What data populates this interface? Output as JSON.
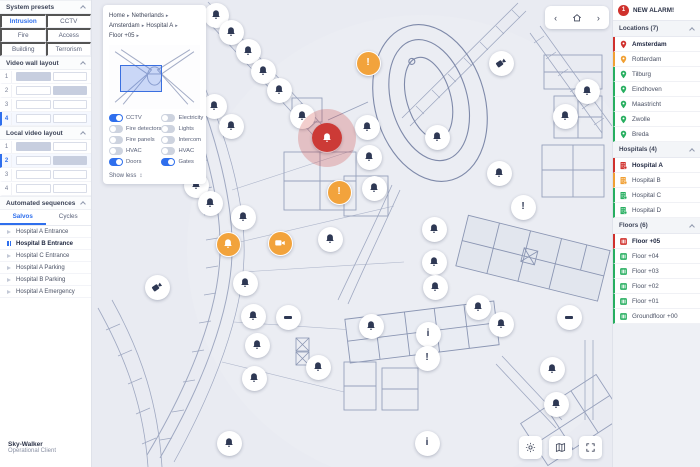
{
  "app": {
    "name": "Sky-Walker",
    "subtitle": "Operational Client"
  },
  "left_sidebar": {
    "system_presets": {
      "title": "System presets",
      "items": [
        {
          "label": "Intrusion",
          "active": true
        },
        {
          "label": "CCTV"
        },
        {
          "label": "Fire"
        },
        {
          "label": "Access"
        },
        {
          "label": "Building"
        },
        {
          "label": "Terrorism"
        }
      ]
    },
    "video_wall": {
      "title": "Video wall layout",
      "rows": [
        {
          "n": "1",
          "t1": "f",
          "t2": "e"
        },
        {
          "n": "2",
          "t1": "e",
          "t2": "f"
        },
        {
          "n": "3",
          "t1": "e",
          "t2": "e"
        },
        {
          "n": "4",
          "t1": "e",
          "t2": "e",
          "selected": true
        }
      ]
    },
    "local_video": {
      "title": "Local video layout",
      "rows": [
        {
          "n": "1",
          "t1": "f",
          "t2": "e"
        },
        {
          "n": "2",
          "t1": "e",
          "t2": "f",
          "selected": true
        },
        {
          "n": "3",
          "t1": "e",
          "t2": "e"
        },
        {
          "n": "4",
          "t1": "e",
          "t2": "e"
        }
      ]
    },
    "sequences": {
      "title": "Automated sequences",
      "tabs": [
        {
          "label": "Salvos",
          "active": true
        },
        {
          "label": "Cycles"
        }
      ],
      "items": [
        {
          "label": "Hospital A Entrance",
          "state": "play"
        },
        {
          "label": "Hospital B Entrance",
          "state": "pause",
          "active": true
        },
        {
          "label": "Hospital C Entrance",
          "state": "play"
        },
        {
          "label": "Hospital A Parking",
          "state": "play"
        },
        {
          "label": "Hospital B Parking",
          "state": "play"
        },
        {
          "label": "Hospital A Emergency",
          "state": "play"
        }
      ]
    }
  },
  "map": {
    "breadcrumb": [
      "Home",
      "Netherlands",
      "Amsterdam",
      "Hospital A",
      "Floor +05"
    ],
    "layers_panel": {
      "toggles": [
        {
          "label": "CCTV",
          "state": "on"
        },
        {
          "label": "Electricity",
          "state": "off"
        },
        {
          "label": "Fire detectors",
          "state": "off"
        },
        {
          "label": "Lights",
          "state": "off"
        },
        {
          "label": "Fire panels",
          "state": "off"
        },
        {
          "label": "Intercom",
          "state": "off"
        },
        {
          "label": "HVAC",
          "state": "off"
        },
        {
          "label": "HVAC",
          "state": "off"
        },
        {
          "label": "Doors",
          "state": "on"
        },
        {
          "label": "Gates",
          "state": "on"
        }
      ],
      "show_less": "Show less"
    },
    "nav": {
      "back": "‹",
      "forward": "›",
      "home_icon": "home-icon"
    },
    "controls": [
      "brightness-icon",
      "map-icon",
      "fullscreen-icon"
    ],
    "markers": [
      {
        "x": 124,
        "y": 15,
        "type": "bell"
      },
      {
        "x": 139,
        "y": 32,
        "type": "bell"
      },
      {
        "x": 156,
        "y": 51,
        "type": "bell"
      },
      {
        "x": 171,
        "y": 71,
        "type": "bell"
      },
      {
        "x": 187,
        "y": 90,
        "type": "bell"
      },
      {
        "x": 210,
        "y": 116,
        "type": "bell"
      },
      {
        "x": 235,
        "y": 138,
        "type": "alarm"
      },
      {
        "x": 276,
        "y": 63,
        "type": "alert-orange"
      },
      {
        "x": 275,
        "y": 127,
        "type": "bell"
      },
      {
        "x": 277,
        "y": 157,
        "type": "bell"
      },
      {
        "x": 282,
        "y": 188,
        "type": "bell"
      },
      {
        "x": 247,
        "y": 192,
        "type": "alert-orange"
      },
      {
        "x": 122,
        "y": 106,
        "type": "bell"
      },
      {
        "x": 139,
        "y": 126,
        "type": "bell"
      },
      {
        "x": 104,
        "y": 185,
        "type": "bell"
      },
      {
        "x": 118,
        "y": 203,
        "type": "bell"
      },
      {
        "x": 151,
        "y": 217,
        "type": "bell"
      },
      {
        "x": 136,
        "y": 244,
        "type": "bell-orange"
      },
      {
        "x": 188,
        "y": 243,
        "type": "camera-orange"
      },
      {
        "x": 238,
        "y": 239,
        "type": "bell"
      },
      {
        "x": 409,
        "y": 63,
        "type": "camera"
      },
      {
        "x": 495,
        "y": 91,
        "type": "bell"
      },
      {
        "x": 473,
        "y": 116,
        "type": "bell"
      },
      {
        "x": 407,
        "y": 173,
        "type": "bell"
      },
      {
        "x": 431,
        "y": 207,
        "type": "alert"
      },
      {
        "x": 345,
        "y": 137,
        "type": "bell"
      },
      {
        "x": 342,
        "y": 229,
        "type": "bell"
      },
      {
        "x": 342,
        "y": 262,
        "type": "bell"
      },
      {
        "x": 343,
        "y": 287,
        "type": "bell"
      },
      {
        "x": 386,
        "y": 307,
        "type": "bell"
      },
      {
        "x": 409,
        "y": 324,
        "type": "bell"
      },
      {
        "x": 477,
        "y": 317,
        "type": "door"
      },
      {
        "x": 336,
        "y": 334,
        "type": "info"
      },
      {
        "x": 335,
        "y": 358,
        "type": "alert"
      },
      {
        "x": 460,
        "y": 369,
        "type": "bell"
      },
      {
        "x": 464,
        "y": 404,
        "type": "bell"
      },
      {
        "x": 335,
        "y": 443,
        "type": "info"
      },
      {
        "x": 65,
        "y": 287,
        "type": "camera"
      },
      {
        "x": 153,
        "y": 283,
        "type": "bell"
      },
      {
        "x": 161,
        "y": 316,
        "type": "bell"
      },
      {
        "x": 196,
        "y": 317,
        "type": "door"
      },
      {
        "x": 165,
        "y": 345,
        "type": "bell"
      },
      {
        "x": 226,
        "y": 367,
        "type": "bell"
      },
      {
        "x": 162,
        "y": 378,
        "type": "bell"
      },
      {
        "x": 137,
        "y": 443,
        "type": "bell"
      },
      {
        "x": 279,
        "y": 326,
        "type": "bell"
      }
    ]
  },
  "right_sidebar": {
    "alarm": {
      "count": "1",
      "label": "NEW ALARM!"
    },
    "locations": {
      "title": "Locations (7)",
      "items": [
        {
          "label": "Amsterdam",
          "status": "red",
          "active": true
        },
        {
          "label": "Rotterdam",
          "status": "orange"
        },
        {
          "label": "Tilburg",
          "status": "green"
        },
        {
          "label": "Eindhoven",
          "status": "green"
        },
        {
          "label": "Maastricht",
          "status": "green"
        },
        {
          "label": "Zwolle",
          "status": "green"
        },
        {
          "label": "Breda",
          "status": "green"
        }
      ]
    },
    "hospitals": {
      "title": "Hospitals (4)",
      "items": [
        {
          "label": "Hospital A",
          "status": "red",
          "active": true
        },
        {
          "label": "Hospital B",
          "status": "orange"
        },
        {
          "label": "Hospital C",
          "status": "green"
        },
        {
          "label": "Hospital D",
          "status": "green"
        }
      ]
    },
    "floors": {
      "title": "Floors (6)",
      "items": [
        {
          "label": "Floor +05",
          "status": "red",
          "active": true
        },
        {
          "label": "Floor +04",
          "status": "green"
        },
        {
          "label": "Floor +03",
          "status": "green"
        },
        {
          "label": "Floor +02",
          "status": "green"
        },
        {
          "label": "Floor +01",
          "status": "green"
        },
        {
          "label": "Groundfloor +00",
          "status": "green"
        }
      ]
    }
  },
  "colors": {
    "accent": "#2f6fed",
    "alarm": "#cd3a36",
    "warning": "#f2a33c",
    "ok": "#27ae60"
  }
}
